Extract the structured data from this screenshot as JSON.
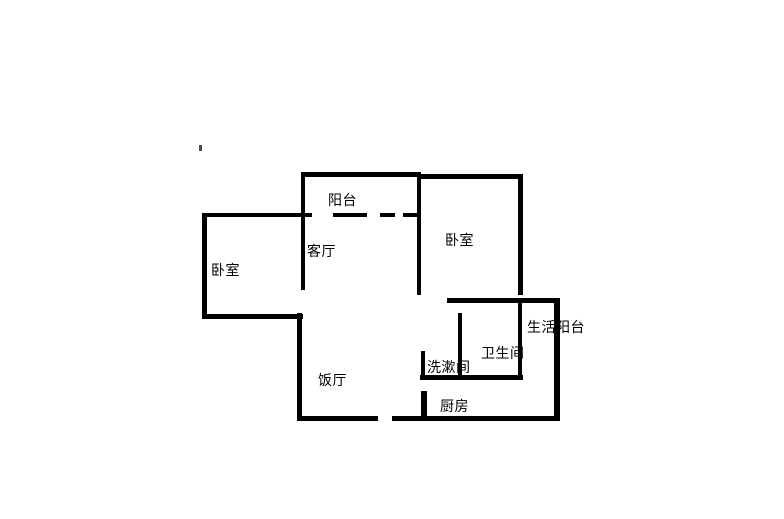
{
  "colors": {
    "wall": "#000000",
    "background": "#ffffff",
    "text": "#000000"
  },
  "floorplan": {
    "type": "apartment-floor-plan",
    "rooms": [
      {
        "id": "balcony",
        "label": "阳台"
      },
      {
        "id": "living-room",
        "label": "客厅"
      },
      {
        "id": "bedroom-left",
        "label": "卧室"
      },
      {
        "id": "bedroom-right",
        "label": "卧室"
      },
      {
        "id": "utility-balcony",
        "label": "生活阳台"
      },
      {
        "id": "bathroom",
        "label": "卫生间"
      },
      {
        "id": "washroom",
        "label": "洗漱间"
      },
      {
        "id": "dining-room",
        "label": "饭厅"
      },
      {
        "id": "kitchen",
        "label": "厨房"
      }
    ]
  }
}
